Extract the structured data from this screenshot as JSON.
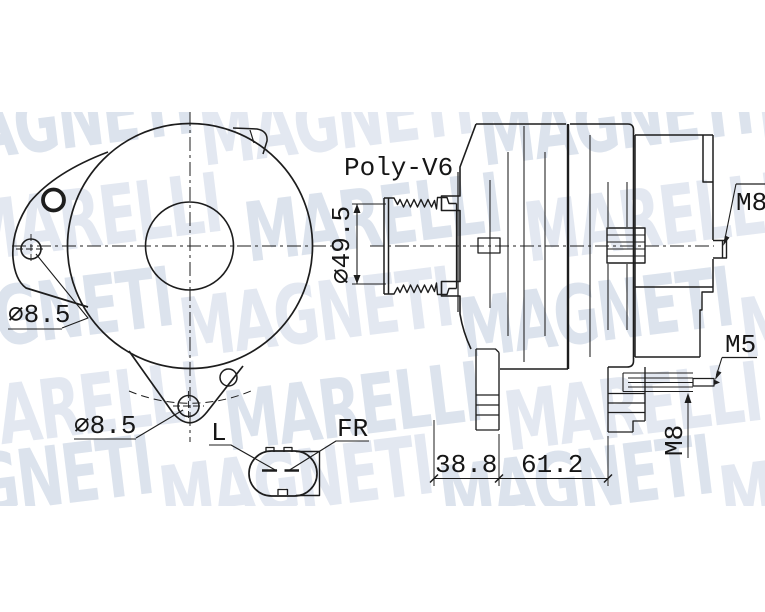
{
  "watermark": {
    "color": "#dce3ed",
    "color_alt": "#e3e8f1",
    "rotation_deg": -7,
    "rows": [
      {
        "word": "MAGNETI",
        "top": 98,
        "offsets": [
          -80,
          200,
          480,
          760
        ]
      },
      {
        "word": "MARELLI",
        "top": 194,
        "offsets": [
          -35,
          245,
          525
        ]
      },
      {
        "word": "MAGNETI",
        "top": 290,
        "offsets": [
          -100,
          180,
          460,
          740
        ]
      },
      {
        "word": "MARELLI",
        "top": 383,
        "offsets": [
          -55,
          225,
          505
        ]
      },
      {
        "word": "MAGNETI",
        "top": 458,
        "offsets": [
          -120,
          160,
          440,
          720
        ]
      }
    ]
  },
  "labels": {
    "pulley_type": "Poly-V6",
    "pulley_diameter": "⌀49.5",
    "front_hole_top": "⌀8.5",
    "front_hole_bottom": "⌀8.5",
    "connector_pin_left": "L",
    "connector_pin_right": "FR",
    "rear_stud": "M8",
    "terminal_screw": "M5",
    "bplus_stud": "M8",
    "dim_front": "38.8",
    "dim_rear": "61.2"
  },
  "style": {
    "line_color": "#1d1d1d",
    "background": "#ffffff"
  }
}
